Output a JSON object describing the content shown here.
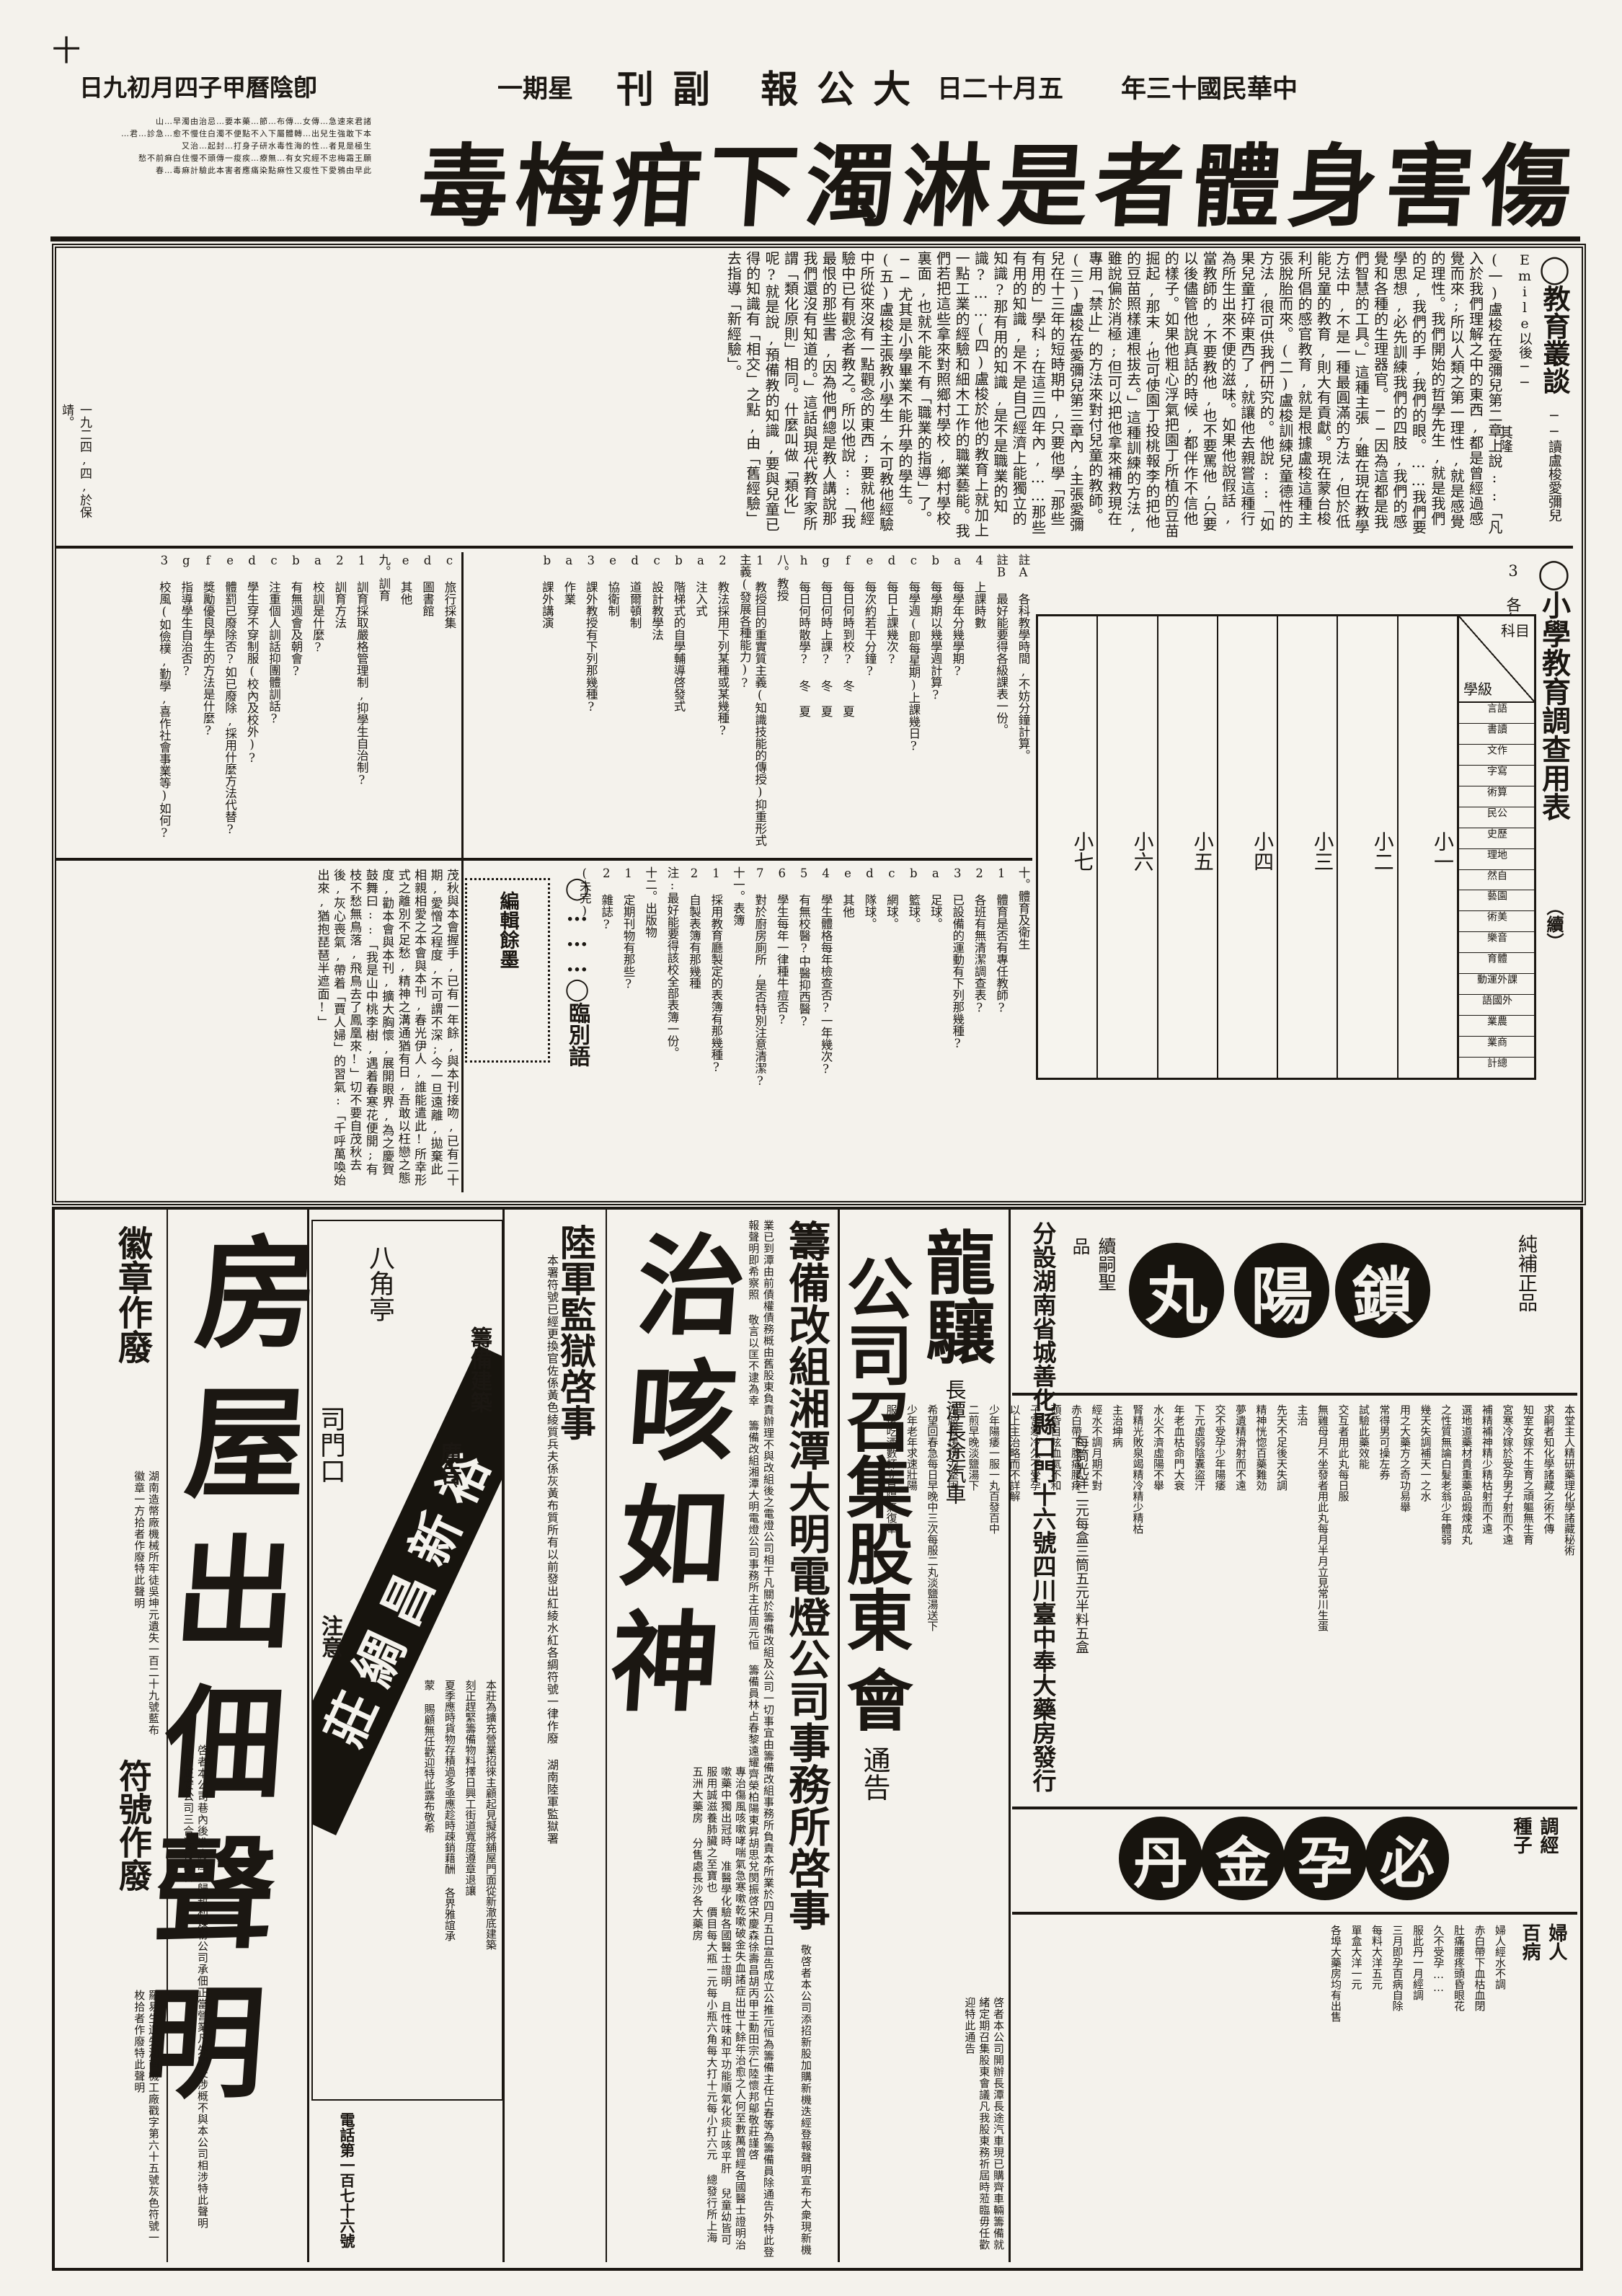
{
  "header": {
    "cross_mark": "十",
    "era_date": "中華民國十三年",
    "date": "五月十二日",
    "masthead": "大公報 副刊",
    "weekday": "星期一",
    "lunar_date": "卽陰曆甲子四月初九日"
  },
  "banner": {
    "headline": "傷害身體者是淋濁下疳梅毒",
    "side_ad_lines": [
      "山…早濁由治忌…要本藥…節…布傳…女傳…急速來君諸",
      "君…診急…愈不慢住白濁不便點不入下屬體轉…出兒生強敢下本…",
      "又治…起封…打身子研水毒性海的性…者見是極生",
      "愁不前痳白住慢不頭傳一痠疾…療無…有女究經不忠梅霜王願",
      "春…毒痳計驗此本害者應痛染點痳性又痠性下愛鴉由早此"
    ]
  },
  "editorial": {
    "article": {
      "title": "◯教育叢談",
      "subtitle": "──讀盧梭愛彌兒Emile以後──",
      "author": "其隆",
      "body": "(一)盧梭在愛彌兒第二章上說::「凡入於我們理解之中的東西,都是曾經過感覺而來;所以人類之第一理性,就是感覺的理性。我們開始的哲學先生,就是我們的足,我們的手,我們的眼。……我們要學思想,必先訓練我們的四肢,我們的感覺和各種的生理器官。──因為這都是我們智慧的工具。」這種主張,雖在現在教學方法中,不是一種最圓滿的方法,但於低能兒童的教育,則大有貢獻。現在蒙台梭利所倡的感官教育,就是根據盧梭這種主張脫胎而來。(二)盧梭訓練兒童德性的方法,很可供我們研究的。他說::「如果兒童打碎東西了,就讓他去親嘗這種行為所生出來不便的滋味。如果他說假話,當教師的,不要教他,也不要罵他,只要以後儘管他說真話的時候,都伴作不信他的樣子。如果他粗心浮氣把園丁所植的豆苗掘起,那末,也可使園丁投桃報李的把他的豆苗照樣連根拔去。」這種訓練的方法,雖說偏於消極;但可以把他拿來補救現在專用「禁止」的方法來對付兒童的教師。(三)盧梭在愛彌兒第三章內,主張愛彌兒在十三年的短時期中,只要他學「那些有用的」學科;在這三四年內,……那些有用的知識,是不是自己經濟上能獨立的知識?那有用的知識,是不是職業的知識?……(四)盧梭於他的教育上就加上一點工業的經驗和細木工作的職業藝能。我們若把這些拿來對照鄉村學校,鄉村學校裏面,也就不能不有「職業的指導」了。──尤其是小學畢業不能升學的學生。(五)盧梭主張教小學生,不可教他經驗中所從來沒有一點觀念的東西;要就他經驗中已有觀念者教之。所以他說::「我最恨的那些書,因為他們總是教人講說那我們還沒有知道的。」這話與現代教育家所謂「類化原則」相同。什麼叫做「類化」呢?就是說,預備教的知識,要與兒童已得的知識有「相交」之點,由「舊經驗」去指導「新經驗」。",
      "date_sign": "一九二四,四,於保靖。"
    },
    "survey": {
      "title": "◯小學教育調查用表",
      "cont": "（續）",
      "item3": "3 各年級每週各科教學時間表::",
      "table": {
        "corner_top": "科目",
        "corner_bottom": "學級",
        "grades": [
          "小一",
          "小二",
          "小三",
          "小四",
          "小五",
          "小六",
          "小七"
        ],
        "subjects": [
          "語言",
          "讀書",
          "作文",
          "寫字",
          "算術",
          "公民",
          "歷史",
          "地理",
          "自然",
          "園藝",
          "美術",
          "音樂",
          "體育",
          "課外運動",
          "外國語",
          "農業",
          "商業",
          "總計"
        ],
        "subjects_grouped": [
          {
            "group": "國語",
            "items": [
              "語言",
              "讀書",
              "作文",
              "寫字"
            ]
          },
          {
            "group": "算術",
            "items": []
          },
          {
            "group": "社會",
            "items": [
              "公民",
              "歷史",
              "地理"
            ]
          },
          {
            "group": "自然",
            "items": [
              "自然",
              "園藝"
            ]
          },
          {
            "group": "藝術",
            "items": [
              "美術",
              "音樂"
            ]
          },
          {
            "group": "體育",
            "items": [
              "體育",
              "課外運動"
            ]
          },
          {
            "group": "外國語",
            "items": []
          },
          {
            "group": "農業",
            "items": []
          },
          {
            "group": "商業",
            "items": []
          },
          {
            "group": "總計",
            "items": []
          }
        ]
      },
      "questions_right": [
        "註A 各科教學時間,不妨分鐘計算。",
        "註B 最好能要得各級課表一份。",
        "4 上課時數",
        "a 每學年分幾學期?",
        "b 每學期以幾學週計算?",
        "c 每學週(即每星期)上課幾日?",
        "d 每日上課幾次?",
        "e 每次約若干分鐘?",
        "f 每日何時到校?  冬  夏",
        "g 每日何時上課?  冬  夏",
        "h 每日何時散學?  冬  夏",
        "八。教授",
        "1 教授目的重實質主義(知識技能的傳授)抑重形式主義(發展各種能力)?",
        "2 教法採用下列某種或某幾種?",
        "a 注入式",
        "b 階梯式的自學輔導啓發式",
        "c 設計教學法",
        "d 道爾頓制",
        "e 協衛制",
        "3 課外教授有下列那幾種?",
        "a 作業",
        "b 課外講演"
      ],
      "questions_left": [
        "c 旅行採集",
        "d 圖書館",
        "e 其他",
        "九。訓育",
        "1 訓育採取嚴格管理制,抑學生自治制?",
        "2 訓育方法",
        "a 校訓是什麼?",
        "b 有無週會及朝會?",
        "c 注重個人訓話抑團體訓話?",
        "d 學生穿不穿制服(校內及校外)?",
        "e 體罰已廢除否?如已廢除,採用什麼方法代替?",
        "f 獎勵優良學生的方法是什麼?",
        "g 指導學生自治否?",
        "3 校風(如儉樸,勤學,喜作社會事業等)如何?"
      ],
      "questions_band3": [
        "十。體育及衛生",
        "1 體育是否有專任教師?",
        "2 各班有無清潔調查表?",
        "3 已設備的運動有下列那幾種?",
        "a 足球。",
        "b 籃球。",
        "c 網球。",
        "d 隊球。",
        "e 其他",
        "4 學生體格每年檢查否?一年幾次?",
        "5 有無校醫?中醫抑西醫?",
        "6 學生每年一律種牛痘否?",
        "7 對於廚房廁所,是否特別注意清潔?",
        "十一。表簿",
        "1 採用教育廳製定的表簿有那幾種?",
        "2 自製表簿有那幾種",
        "注:最好能要得該校全部表簿一份。",
        "十二。出版物",
        "1 定期刊物有那些?",
        "2 雜誌?",
        "(未完)"
      ]
    },
    "farewell": {
      "title": "◯………◯臨別語",
      "box_label": "編輯餘墨",
      "body": "茂秋與本會握手,已有一年餘,與本刊接吻,已有二十期,愛憎之程度,不可謂不深;今一旦遠離,拋棄此相親相愛之本會與本刊,春光伊人,誰能遣此!所幸形式之離別不足愁,精神之溝通猶有日,吾敢以枉戀之態度,勸本會與本刊,擴大胸懷,展開眼界,為之慶賀鼓舞曰::「我是山中桃李樹,遇着春寒花便開;有枝不愁無鳥落,飛鳥去了鳳凰來!」切不要自茂秋去後,灰心喪氣,帶着「賈人婦」的習氣:「千呼萬喚始出來,猶抱琵琶半遮面!」"
    }
  },
  "ads": {
    "suoyangwan": {
      "tag_right": "純補正品",
      "circles": [
        "鎖",
        "陽",
        "丸"
      ],
      "tag_left": "續嗣聖品",
      "body": [
        "本堂主人精研藥理化學諸藏秘術",
        "求嗣者知化學諸藏之術不傳",
        "知室女嫁不生育之頑軀無生育",
        "宮寒冷嫁於受孕男子射而不遠",
        "補精補神精少精枯射而不遠",
        "選地道藥材貴重藥品煅煉成丸",
        "之性質無論白髮老翁少年體弱",
        "幾天失調補天一之水",
        "用之大藥方之奇功易舉",
        "常得男可操左券",
        "試驗此藥效能",
        "交互者用此丸每日服",
        "無雞母月不坐發者用此丸每月半月立見常川生蛋",
        "主治",
        "先天不足後天失調",
        "精神恍惚百藥難効",
        "夢遺精滑射而不遠",
        "交不受孕少年陽痿",
        "下元虛弱陰囊盜汗",
        "年老血枯命門大衰",
        "水火不濟虛陽不舉",
        "腎精光敗泉竭精冷精少精枯",
        "主治坤病",
        "經水不調月期不對",
        "赤白帶下腹痛腰疼",
        "頭昏目眩血氣不和",
        "子宮寒冷久不受孕",
        "以上主治略而不詳解",
        "少年陽痿一服一丸百發百中",
        "二煎早晚淡鹽湯下",
        "四肢發煖精力堅固",
        "希望回春急每日早晚中三次每服二丸淡鹽湯送下",
        "少年老年求速壯陽",
        "服後吃酒數杯立見陽氣復舉"
      ],
      "distributor": "分設湖南省城善化縣口門十六號四川臺中奉大藥房發行",
      "price": "每筒光洋二元每盒三筒五元半料五盒"
    },
    "biyunjindan": {
      "label": "調經種子",
      "circles": [
        "必",
        "孕",
        "金",
        "丹"
      ],
      "women_label": "婦人百病",
      "women_body": [
        "婦人經水不調",
        "赤白帶下血枯血閉",
        "肚痛腰疼頭昏眼花",
        "久不受孕……",
        "服此丹一月經調",
        "三月即孕百病自除",
        "每料大洋五元",
        "單盒大洋一元",
        "各埠大藥房均有出售"
      ]
    },
    "longxiang": {
      "name": "龍驤",
      "subtitle": "長潭長途汽車",
      "title2": "公司召集股東",
      "title3": "會",
      "notice": "通告",
      "body": "啓者本公司開辦長潭長途汽車現已購齊車輛籌備就緒定期召集股東會議凡我股東務祈屆時蒞臨毋任歡迎特此通告"
    },
    "daming": {
      "title": "籌備改組湘潭大明電燈公司事務所啓事",
      "body": "敬啓者本公司添招新股加購新機迭經登報聲明宣布大衆現新機業已到潭由前債權債務概由舊股東負責辦理不與改組後之電燈公司相干凡關於籌備改組及公司一切事宜由籌備改組事務所負責本所業於四月五日宣告成立公推元恒為籌備主任占春等為籌備員除通告外特此登報聲明即希察照 敬言以匡不逮為幸 籌備改組湘潭大明電燈公司事務所主任周元恒 籌備員林占春黎遠耀齊榮柏陽東昇胡思兌閔振啓宋慶森徐壽昌胡丙甲王勳田宗仁陸懷邦鄔敬莊謹啓"
    },
    "zhike": {
      "title": "治咳如神",
      "body": "專治傷風咳嗽哮喘氣急寒嗽乾嗽破金失血諸症出世十餘年治愈之人何至數萬曾經各國醫士證明治嗽藥中獨出冠時 准醫學化驗各國醫士證明 且性味和平功能順氣化痰止咳平肝 兒童幼皆可服用誠滋養肺臟之至寶也",
      "price": "價目每大瓶一元每小瓶六角每大打十元每小打六元",
      "seller": "總發行所上海五洲大藥房 分售處長沙各大藥房"
    },
    "prison": {
      "title": "陸軍監獄啓事",
      "body": "本署符號已經更換官佐係黃色綾質兵夫係灰黃布質所有以前發出紅綾水紅各綢符號一律作廢",
      "sign": "湖南陸軍監獄署"
    },
    "yuxinchang": {
      "ribbon": "裕新昌綢莊",
      "loc_top": "八角亭",
      "loc_left": "司門口",
      "right_label": "籌備建築",
      "right_label2": "廣告",
      "attention": "注意",
      "body": [
        "本莊為擴充營業招徠主顧起見擬將舖屋門面從新澈底建築",
        "刻正趕緊籌備物料擇日興工街道寬度遵章退讓",
        "夏季應時貨物存積過多亟應趁時疎銷藉酬 各界雅誼承",
        "蒙 賜顧無任歡迎特此露布敬希"
      ],
      "phone": "電話第一百七十六號"
    },
    "badge": {
      "title": "徽章作廢",
      "body": "湖南造幣廠機械所牢徒吳坤元遺失一百二十九號藍布徽章一方拾者作廢特此聲明"
    },
    "fuhao": {
      "title": "符號作廢",
      "body": "羅易生遺失湖南機工廠戳字第六十五號灰色符號一枚拾者作廢特此聲明"
    },
    "house": {
      "title": "房屋出佃聲明",
      "body": "啓者本公司巷內後進房屋已歸新利煤粉公司承佃正當營業凡外間交涉概不與本公司相涉特此聲明",
      "sign": "日商正安公司三合洋行同啓"
    }
  }
}
